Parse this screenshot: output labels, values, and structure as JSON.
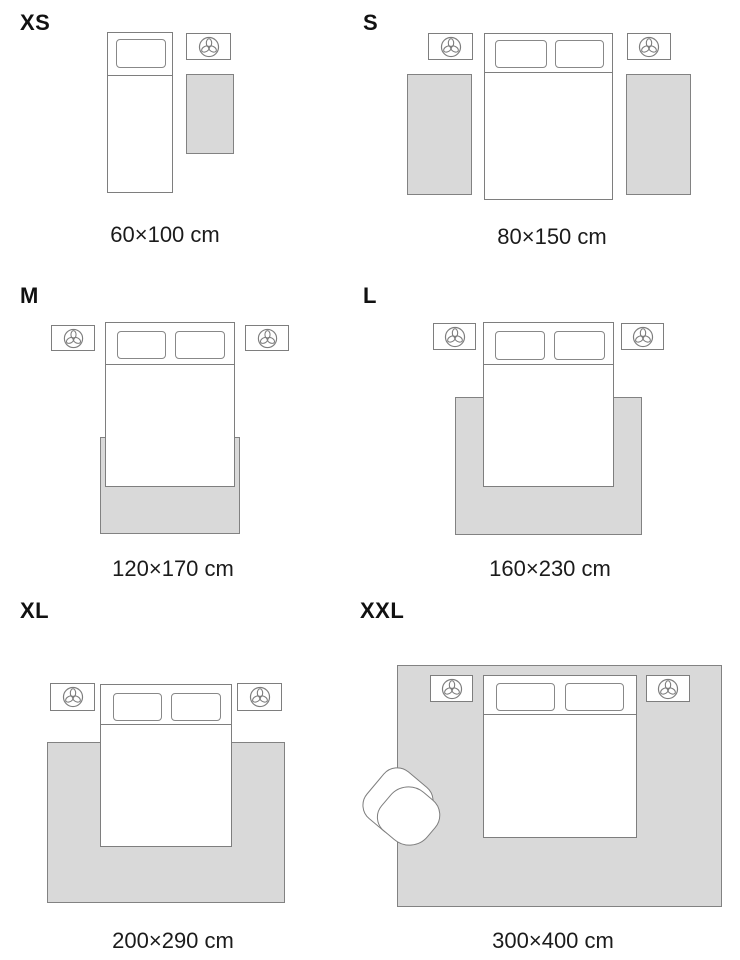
{
  "title": "Rug size guide",
  "colors": {
    "background": "#ffffff",
    "outline_gray": "#7e7e7e",
    "rug_fill": "#d9d9d9",
    "rug_border": "#828282",
    "text": "#1b1b1b"
  },
  "icons": {
    "nightstand_icon": "plant-top-view-icon"
  },
  "sizes": [
    {
      "id": "xs",
      "label": "XS",
      "caption": "60×100 cm"
    },
    {
      "id": "s",
      "label": "S",
      "caption": "80×150 cm"
    },
    {
      "id": "m",
      "label": "M",
      "caption": "120×170 cm"
    },
    {
      "id": "l",
      "label": "L",
      "caption": "160×230 cm"
    },
    {
      "id": "xl",
      "label": "XL",
      "caption": "200×290 cm"
    },
    {
      "id": "xxl",
      "label": "XXL",
      "caption": "300×400 cm"
    }
  ]
}
